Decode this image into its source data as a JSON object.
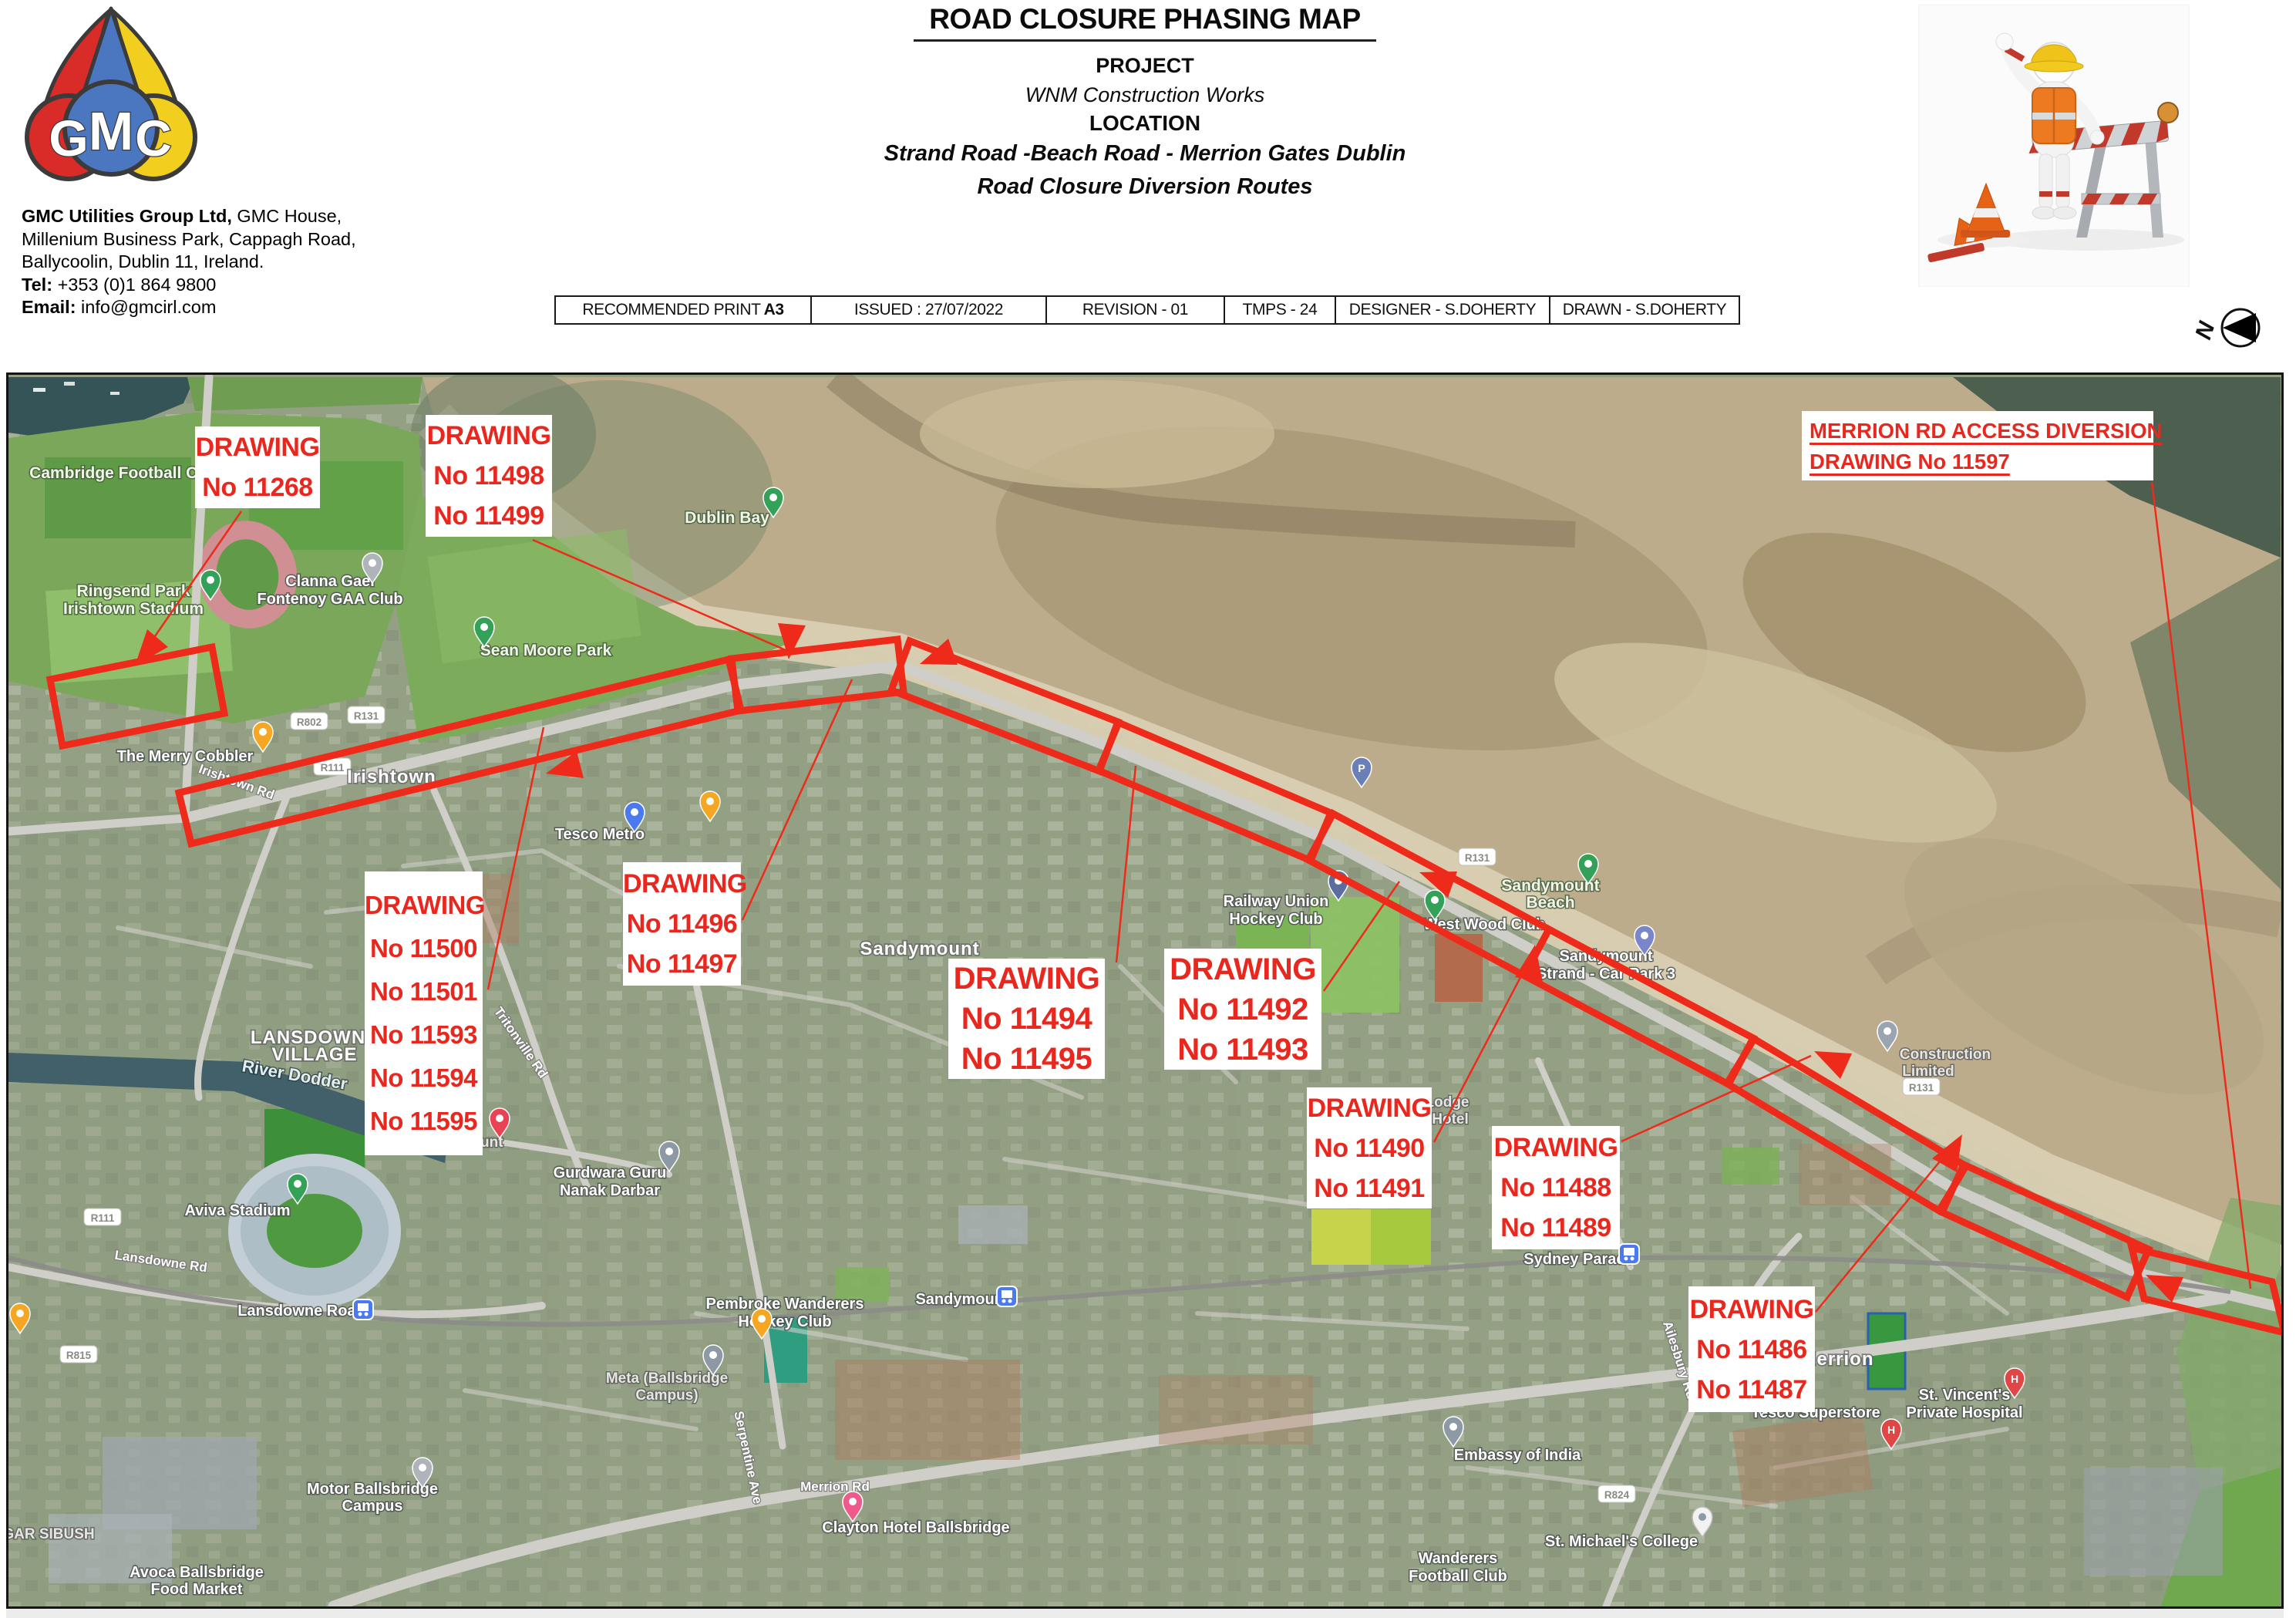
{
  "colors": {
    "annotation_red": "#e8281e",
    "route_red": "#ee2b1a",
    "logo_red": "#d92b27",
    "logo_blue": "#4a77c0",
    "logo_yellow": "#f2cf1e",
    "map_border": "#141414"
  },
  "header": {
    "logo_letters": [
      "G",
      "M",
      "C"
    ],
    "company_line1_bold": "GMC Utilities Group Ltd,",
    "company_line1_rest": " GMC House,",
    "company_line2": "Millenium Business Park, Cappagh Road,",
    "company_line3": "Ballycoolin, Dublin 11, Ireland.",
    "tel_label": "Tel:",
    "tel_value": " +353 (0)1 864 9800",
    "email_label": "Email:",
    "email_value": " info@gmcirl.com",
    "title": "ROAD CLOSURE PHASING MAP",
    "project_label": "PROJECT",
    "project_value": "WNM Construction Works",
    "location_label": "LOCATION",
    "location_line1": "Strand Road -Beach Road - Merrion Gates Dublin",
    "location_line2": "Road Closure Diversion Routes",
    "meta": {
      "print_label": "RECOMMENDED PRINT",
      "print_value": "A3",
      "issued": "ISSUED : 27/07/2022",
      "revision": "REVISION - 01",
      "tmps": "TMPS - 24",
      "designer": "DESIGNER - S.DOHERTY",
      "drawn": "DRAWN - S.DOHERTY"
    },
    "north_label": "N"
  },
  "map": {
    "boxes": [
      {
        "lines": [
          "DRAWING",
          "No 11268"
        ]
      },
      {
        "lines": [
          "DRAWING",
          "No 11498",
          "No 11499"
        ]
      },
      {
        "lines": [
          "DRAWING",
          "No 11500",
          "No 11501",
          "No 11593",
          "No 11594",
          "No 11595"
        ]
      },
      {
        "lines": [
          "DRAWING",
          "No 11496",
          "No 11497"
        ]
      },
      {
        "lines": [
          "DRAWING",
          "No 11494",
          "No 11495"
        ]
      },
      {
        "lines": [
          "DRAWING",
          "No 11492",
          "No 11493"
        ]
      },
      {
        "lines": [
          "DRAWING",
          "No 11490",
          "No 11491"
        ]
      },
      {
        "lines": [
          "DRAWING",
          "No 11488",
          "No 11489"
        ]
      },
      {
        "lines": [
          "DRAWING",
          "No 11486",
          "No 11487"
        ]
      }
    ],
    "merrion_box": {
      "line1": "MERRION RD ACCESS DIVERSION",
      "line2": "DRAWING No 11597"
    },
    "labels": [
      {
        "text": "Cambridge Football Club"
      },
      {
        "text": "Ringsend Park"
      },
      {
        "text": "Irishtown Stadium"
      },
      {
        "text": "Clanna Gael"
      },
      {
        "text": "Fontenoy GAA Club"
      },
      {
        "text": "Dublin Bay"
      },
      {
        "text": "Sean Moore Park"
      },
      {
        "text": "Irishtown"
      },
      {
        "text": "The Merry Cobbler"
      },
      {
        "text": "Irishtown Rd"
      },
      {
        "text": "Tesco Metro"
      },
      {
        "text": "Sandymount"
      },
      {
        "text": "Tritonville Rd"
      },
      {
        "text": "Sandymount"
      },
      {
        "text": "Gurdwara Guru"
      },
      {
        "text": "Nanak Darbar"
      },
      {
        "text": "LANSDOWNE"
      },
      {
        "text": "VILLAGE"
      },
      {
        "text": "River Dodder"
      },
      {
        "text": "Aviva Stadium"
      },
      {
        "text": "Lansdowne Road"
      },
      {
        "text": "Railway Union"
      },
      {
        "text": "Hockey Club"
      },
      {
        "text": "West Wood Club"
      },
      {
        "text": "Sandymount"
      },
      {
        "text": "Beach"
      },
      {
        "text": "Sandymount"
      },
      {
        "text": "Strand - Car Park 3"
      },
      {
        "text": "Construction"
      },
      {
        "text": "Limited"
      },
      {
        "text": "Sydney Parade"
      },
      {
        "text": "Lodge"
      },
      {
        "text": "Hotel"
      },
      {
        "text": "Sandymount"
      },
      {
        "text": "Pembroke Wanderers"
      },
      {
        "text": "Hockey Club"
      },
      {
        "text": "Meta (Ballsbridge"
      },
      {
        "text": "Campus)"
      },
      {
        "text": "Serpentine Ave"
      },
      {
        "text": "Merrion Rd"
      },
      {
        "text": "Clayton Hotel Ballsbridge"
      },
      {
        "text": "Embassy of India"
      },
      {
        "text": "St. Michael's College"
      },
      {
        "text": "Wanderers"
      },
      {
        "text": "Football Club"
      },
      {
        "text": "St. Vincent's"
      },
      {
        "text": "Private Hospital"
      },
      {
        "text": "Merrion"
      },
      {
        "text": "Tesco Superstore"
      },
      {
        "text": "Ailesbury Rd"
      },
      {
        "text": "Avoca Ballsbridge"
      },
      {
        "text": "Food Market"
      },
      {
        "text": "GAR SIBUSH"
      },
      {
        "text": "Lansdowne Rd"
      },
      {
        "text": "Motor Ballsbridge"
      },
      {
        "text": "Campus"
      }
    ],
    "shields": [
      {
        "text": "R131"
      },
      {
        "text": "R802"
      },
      {
        "text": "R111"
      },
      {
        "text": "R111"
      },
      {
        "text": "R815"
      },
      {
        "text": "R131"
      },
      {
        "text": "R131"
      },
      {
        "text": "R824"
      }
    ],
    "pin_letters": {
      "hospital": "H",
      "parking": "P"
    }
  }
}
